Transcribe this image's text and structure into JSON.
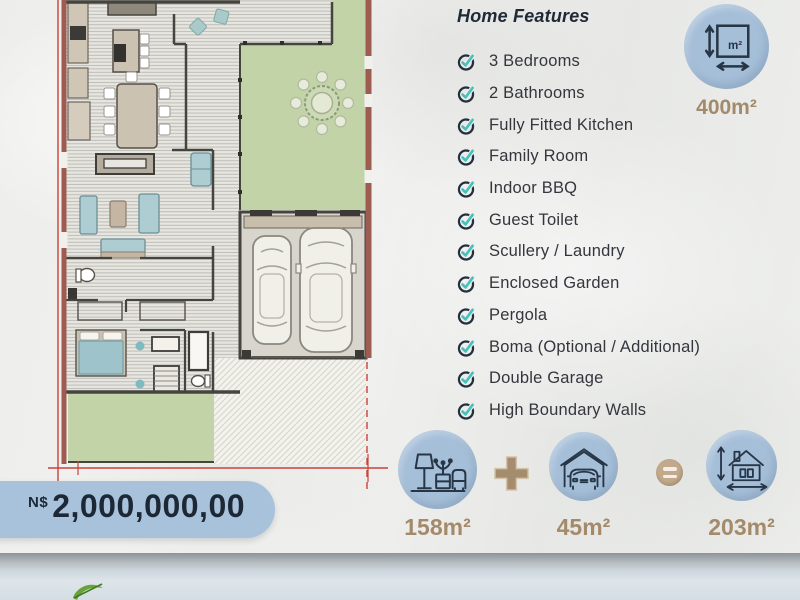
{
  "header": {
    "title": "Home Features"
  },
  "features": [
    "3 Bedrooms",
    "2 Bathrooms",
    "Fully Fitted Kitchen",
    "Family Room",
    "Indoor BBQ",
    "Guest Toilet",
    "Scullery / Laundry",
    "Enclosed Garden",
    "Pergola",
    "Boma (Optional / Additional)",
    "Double Garage",
    "High Boundary Walls"
  ],
  "stand_size": {
    "area": "400m²",
    "icon_label": "m²"
  },
  "area_breakdown": {
    "living": {
      "area": "158m²"
    },
    "plus": "+",
    "garage": {
      "area": "45m²"
    },
    "equals": "=",
    "total": {
      "area": "203m²"
    }
  },
  "price": {
    "currency": "N$",
    "amount": "2,000,000,00"
  },
  "colors": {
    "accent_blue": "#a6bfd9",
    "tan": "#a28a6a",
    "navy": "#263646",
    "teal": "#47c1ba",
    "price_text": "#1d2836",
    "lawn_green": "#c3d3a8",
    "boundary_red": "#9d5b51",
    "dimension_red": "#c9423a"
  }
}
